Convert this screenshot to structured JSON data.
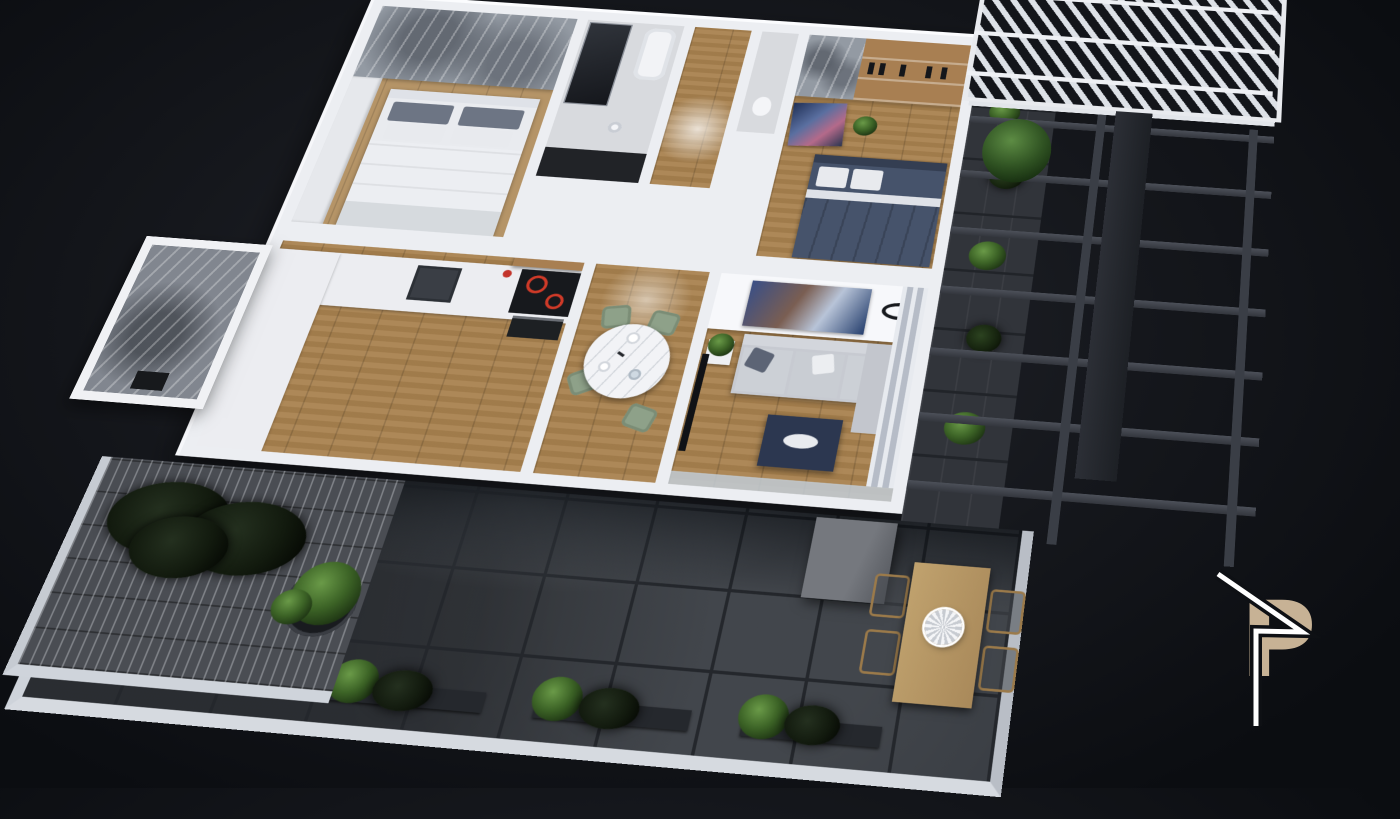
{
  "scene": {
    "description": "3D isometric night render of an apartment floor plan with terrace and pergola",
    "background": {
      "base": "#0b0d11",
      "glow": "#23262d"
    }
  },
  "logo": {
    "letter": "P",
    "letter_color": "#c7b295",
    "line_color": "#ffffff"
  },
  "palette": {
    "wall_white": "#eceef2",
    "wood_floor": "#a9824f",
    "accent_wall_gray": "#939aa3",
    "terrace_tile": "#383c42",
    "brick_paving": "#4a4d53",
    "sofa_gray": "#c7cad1",
    "coffee_table_navy": "#2c3750",
    "dining_chair_sage": "#8ea189",
    "outdoor_table_tan": "#bfa06a",
    "bed2_duvet_navy": "#46536b",
    "cooktop_ring_red": "#cf3a28",
    "pergola_beam": "#3a3e46",
    "plant_green": "#3c6326"
  },
  "apartment": {
    "rooms": [
      {
        "name": "bedroom-1",
        "floor": "wood",
        "features": [
          "gray-accent-wall",
          "wardrobe",
          "double-bed-white-duvet",
          "gray-pillows"
        ]
      },
      {
        "name": "bathroom-1",
        "floor": "tile",
        "features": [
          "glass-shower",
          "bathtub",
          "pedestal-sink",
          "dark-tile-strip"
        ]
      },
      {
        "name": "hallway",
        "floor": "wood",
        "features": [
          "sunlight-patch"
        ]
      },
      {
        "name": "bathroom-2",
        "floor": "tile",
        "features": [
          "toilet"
        ]
      },
      {
        "name": "bedroom-2",
        "floor": "wood",
        "features": [
          "wood-shelves-with-bottles",
          "abstract-art",
          "double-bed-navy-duvet",
          "plant"
        ]
      },
      {
        "name": "kitchen",
        "floor": "wood",
        "features": [
          "l-shaped-white-counter",
          "sink",
          "induction-cooktop-red-rings",
          "oven",
          "wood-shelf",
          "fruit-bowl"
        ]
      },
      {
        "name": "dining-area",
        "floor": "wood",
        "features": [
          "round-marble-table",
          "place-settings",
          "four-sage-chairs"
        ]
      },
      {
        "name": "living-room",
        "floor": "wood",
        "features": [
          "abstract-art",
          "ceiling-light",
          "gray-sofa-with-pillows",
          "navy-coffee-table",
          "side-table-plant",
          "tv",
          "curtains",
          "glass-wall"
        ]
      },
      {
        "name": "utility-room",
        "floor": "stone-marble",
        "features": [
          "dark-fixture"
        ]
      }
    ],
    "outdoor": {
      "terrace": {
        "floor": "large-dark-gray-tiles",
        "items": [
          "outdoor-wood-dining-table",
          "woven-bowl",
          "four-wood-chairs",
          "gray-storage-cube",
          "three-planter-boxes-with-plants",
          "white-edge-wall"
        ]
      },
      "brick_patio": {
        "floor": "brick",
        "items": [
          "dark-shrub-bed",
          "monstera-plant"
        ]
      },
      "side_walkway": {
        "floor": "dark-tiles",
        "items": [
          "climbing-plants"
        ]
      },
      "pergola": {
        "items": [
          "white-slatted-roof",
          "dark-horizontal-beams",
          "support-rails",
          "dark-column",
          "palm-plant"
        ]
      }
    }
  }
}
